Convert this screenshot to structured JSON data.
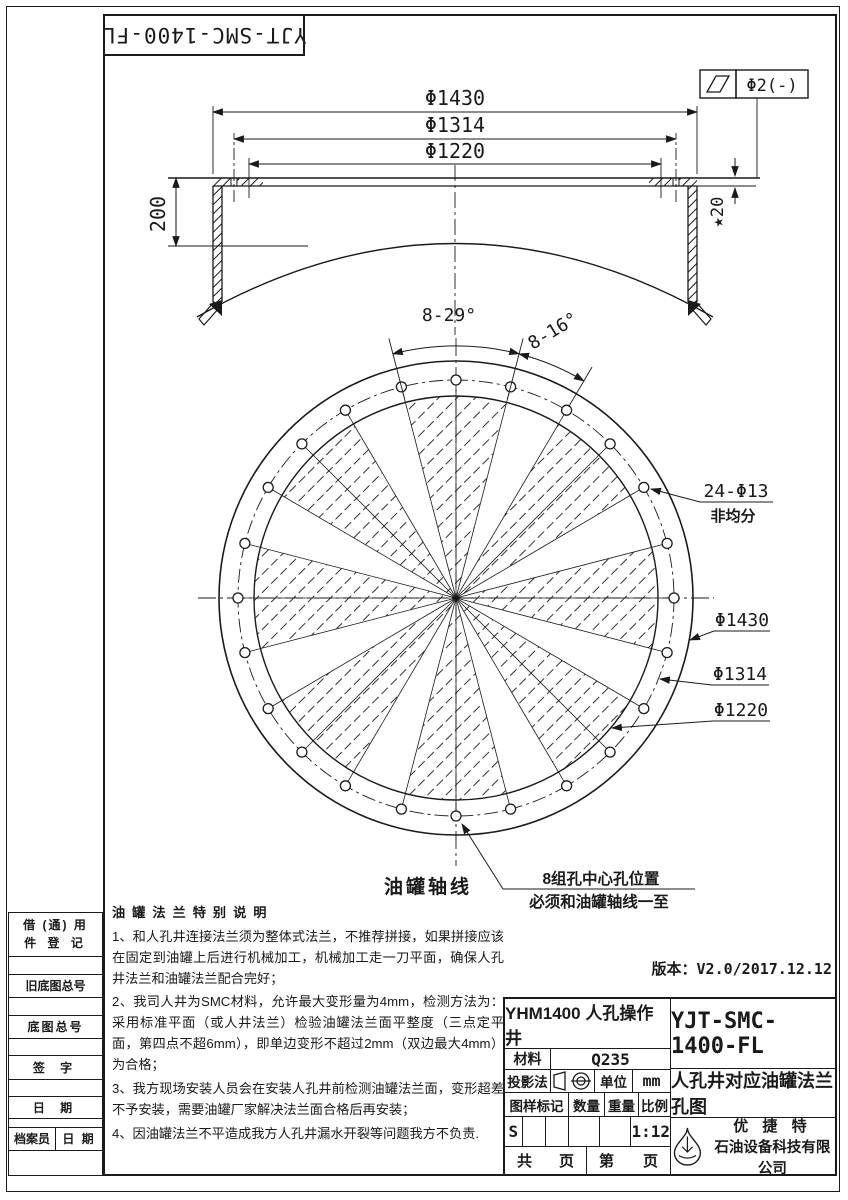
{
  "corner_label": "YJT-SMC-1400-FL",
  "tolerance": {
    "symbol": "flatness",
    "value": "Φ2(-)"
  },
  "section": {
    "d_outer": "Φ1430",
    "d_mid": "Φ1314",
    "d_inner": "Φ1220",
    "height": "200",
    "thickness": "★20"
  },
  "plan_view": {
    "angle_group": "8-29°",
    "angle_gap": "8-16°",
    "holes_label": "24-Φ13",
    "holes_note": "非均分",
    "d_outer": "Φ1430",
    "d_bolt": "Φ1314",
    "d_inner": "Φ1220",
    "axis_label": "油罐轴线",
    "holes_pos_note1": "8组孔中心孔位置",
    "holes_pos_note2": "必须和油罐轴线一至",
    "geometry": {
      "cx": 456,
      "cy": 598,
      "r_outer": 237,
      "r_bolt": 218,
      "r_inner": 202,
      "hole_r": 5,
      "groups": 8,
      "group_span": 29,
      "gap_span": 16,
      "start_angle": 90
    }
  },
  "notes": {
    "title": "油罐法兰特别说明",
    "items": [
      "1、和人孔井连接法兰须为整体式法兰，不推荐拼接，如果拼接应该在固定到油罐上后进行机械加工，机械加工走一刀平面，确保人孔井法兰和油罐法兰配合完好；",
      "2、我司人井为SMC材料，允许最大变形量为4mm，检测方法为：采用标准平面（或人井法兰）检验油罐法兰面平整度（三点定平面，第四点不超6mm），即单边变形不超过2mm（双边最大4mm）为合格；",
      "3、我方现场安装人员会在安装人孔井前检测油罐法兰面，变形超差不予安装，需要油罐厂家解决法兰面合格后再安装；",
      "4、因油罐法兰不平造成我方人孔井漏水开裂等问题我方不负责."
    ]
  },
  "side_table": {
    "r1a": "借 (通) 用",
    "r1b": "件 登 记",
    "r2": "旧底图总号",
    "r3": "底图总号",
    "r4": "签 字",
    "r5": "日 期",
    "r6a": "档案员",
    "r6b": "日 期"
  },
  "version": "版本：V2.0/2017.12.12",
  "title_block": {
    "model": "YHM1400 人孔操作井",
    "code": "YJT-SMC-1400-FL",
    "material_label": "材料",
    "material": "Q235",
    "projection_label": "投影法",
    "unit_label": "单位",
    "unit": "mm",
    "mark_label": "图样标记",
    "qty_label": "数量",
    "weight_label": "重量",
    "scale_label": "比例",
    "mark_value": "S",
    "scale_value": "1:12",
    "total_l": "共",
    "total_r": "页",
    "page_l": "第",
    "page_r": "页",
    "title": "人孔井对应油罐法兰孔图",
    "company_line1": "优 捷 特",
    "company_line2": "石油设备科技有限公司"
  }
}
